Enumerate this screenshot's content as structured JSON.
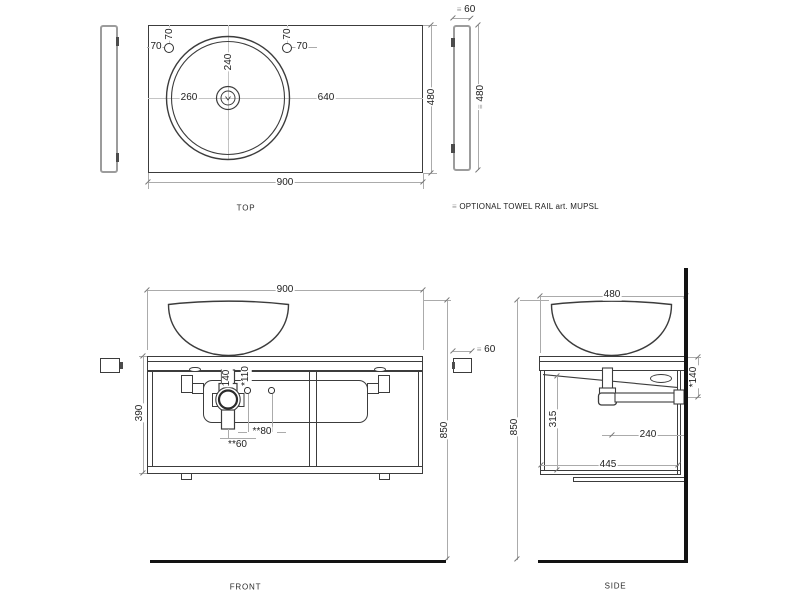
{
  "legend": {
    "symbol": "≡",
    "text": "OPTIONAL TOWEL RAIL art. MUPSL"
  },
  "symbols": {
    "towel_rail": "≡"
  },
  "colors": {
    "object_line": "#3c3c3c",
    "dimension_line": "#ababab",
    "text": "#1d1d1d",
    "thick_wall_floor": "#131313",
    "rail_gray": "#9c9c9c",
    "clip_tab": "#4c4c4c",
    "centerline": "#c4c4c4",
    "background": "#ffffff"
  },
  "top": {
    "label": "TOP",
    "width": "900",
    "depth": "480",
    "basin_from_back": "240",
    "basin_center_from_left": "260",
    "basin_center_to_right": "640",
    "tap_left_v": "70",
    "tap_left_h": "70",
    "tap_right_v": "70",
    "tap_right_h": "70",
    "rail_thickness": "60",
    "rail_length": "480"
  },
  "front": {
    "label": "FRONT",
    "width": "900",
    "cabinet_height": "390",
    "total_height": "850",
    "trap_drop": "140",
    "hole_drop": "*110",
    "hole_spacing": "**80",
    "trap_to_hole": "**60"
  },
  "side": {
    "label": "SIDE",
    "depth": "480",
    "total_height": "850",
    "interior_height": "315",
    "trap_to_wall": "240",
    "cabinet_depth": "445",
    "outlet_drop": "*140",
    "rail_thickness": "60"
  }
}
